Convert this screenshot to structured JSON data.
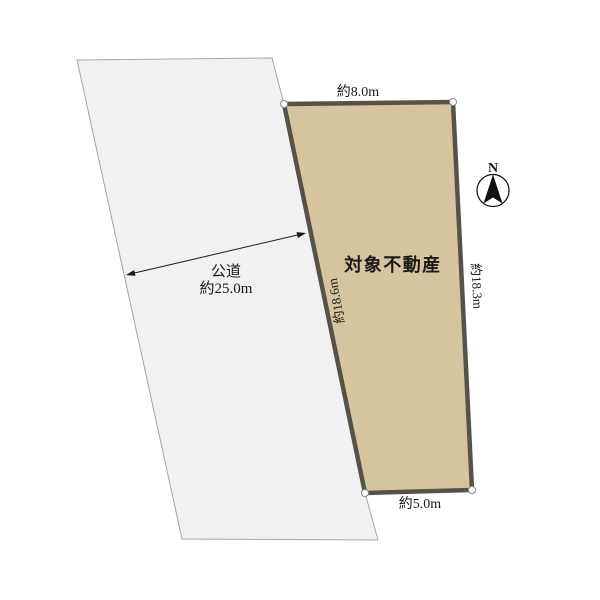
{
  "diagram_title": "land-plot-survey-diagram",
  "road": {
    "name_label": "公道",
    "width_label": "約25.0m"
  },
  "plot": {
    "name_label": "対象不動産",
    "dimensions": {
      "top": "約8.0m",
      "right": "約18.3m",
      "left": "約18.6m",
      "bottom": "約5.0m"
    }
  },
  "compass": {
    "label": "N"
  },
  "colors": {
    "background": "#ffffff",
    "plot_fill": "#d5c49e",
    "plot_border": "#56524a",
    "road_fill": "#f1f1f3",
    "road_border": "#a6a6a6",
    "text": "#1a1a1a",
    "arrow": "#1a1a1a",
    "vertex_fill": "#ffffff",
    "vertex_stroke": "#8a8a8a",
    "compass_stroke": "#111111"
  }
}
